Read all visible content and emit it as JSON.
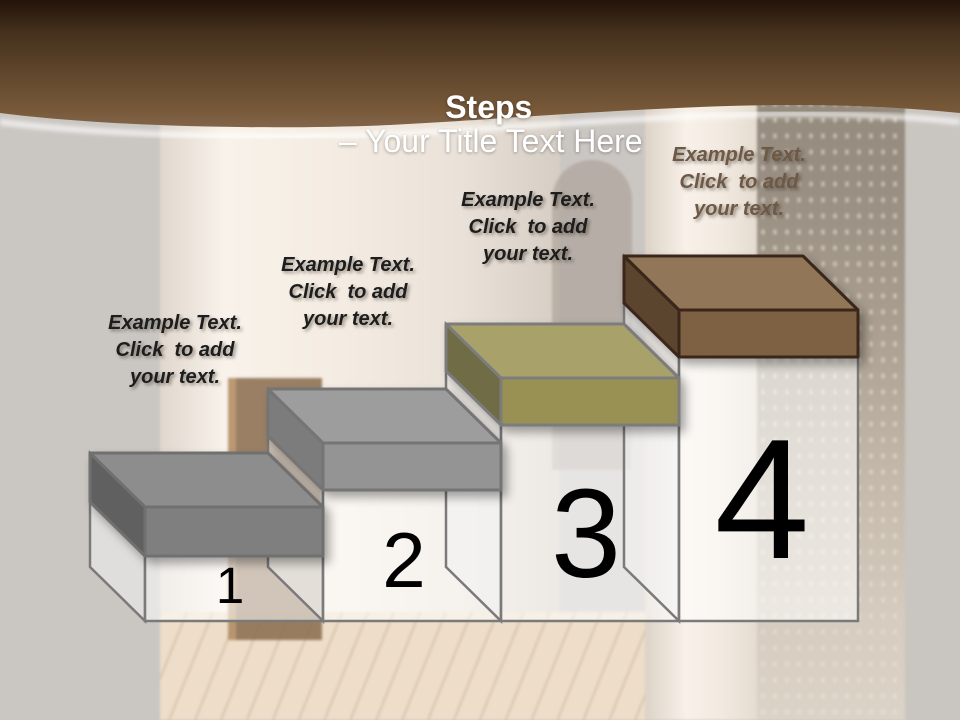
{
  "slide": {
    "title_bold": "Steps",
    "title_rest": "– Your Title Text Here",
    "band": {
      "top_color": "#231309",
      "mid_color": "#62482e",
      "bottom_color": "#82644a"
    },
    "diagram": {
      "column_fill": "rgba(255,255,255,0.55)",
      "column_side_fill": "rgba(242,242,242,0.55)",
      "column_outline": "#7a7a7a",
      "numbers_color": "#000000"
    },
    "steps": [
      {
        "number": "1",
        "label_lines": [
          "Example Text.",
          "Click  to add",
          "your text."
        ],
        "label_color": "#1d1d1d",
        "colors": {
          "top": "#8d8d8d",
          "front": "#7f7f7f",
          "side": "#616161",
          "outline": "#6f6f6f"
        }
      },
      {
        "number": "2",
        "label_lines": [
          "Example Text.",
          "Click  to add",
          "your text."
        ],
        "label_color": "#1d1d1d",
        "colors": {
          "top": "#9d9d9d",
          "front": "#949494",
          "side": "#7b7b7b",
          "outline": "#757575"
        }
      },
      {
        "number": "3",
        "label_lines": [
          "Example Text.",
          "Click  to add",
          "your text."
        ],
        "label_color": "#1d1d1d",
        "colors": {
          "top": "#a8a26b",
          "front": "#989152",
          "side": "#6f6c45",
          "outline": "#7c7c7c"
        }
      },
      {
        "number": "4",
        "label_lines": [
          "Example Text.",
          "Click  to add",
          "your text."
        ],
        "label_color": "#6e5846",
        "colors": {
          "top": "#927659",
          "front": "#7e6042",
          "side": "#5c442f",
          "outline": "#3a281a"
        }
      }
    ]
  }
}
